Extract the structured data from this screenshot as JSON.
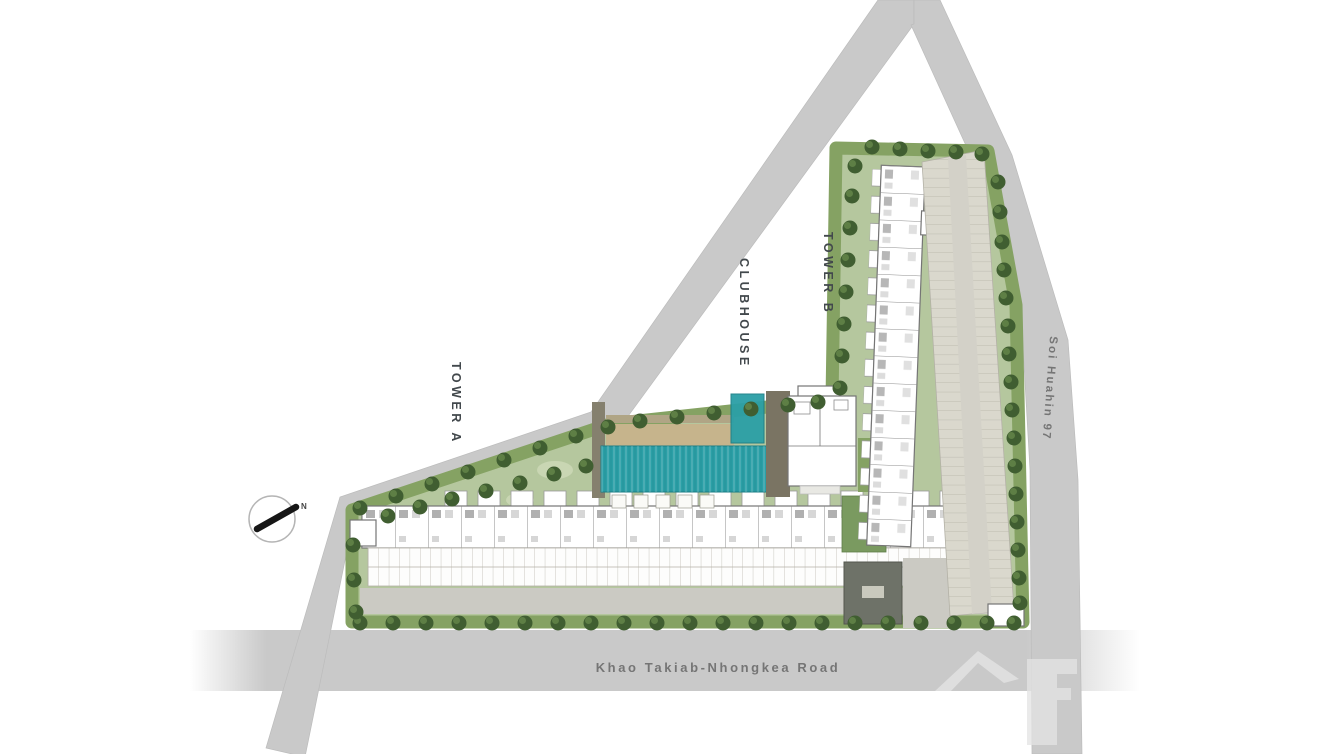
{
  "site_plan": {
    "buildings": [
      {
        "id": "tower-a",
        "label": "TOWER A"
      },
      {
        "id": "tower-b",
        "label": "TOWER B"
      },
      {
        "id": "clubhouse",
        "label": "CLUBHOUSE"
      }
    ],
    "roads": [
      {
        "id": "khao-takiab-road",
        "label": "Khao Takiab-Nhongkea Road",
        "orientation": "horizontal"
      },
      {
        "id": "soi-huahin-97",
        "label": "Soi Huahin 97",
        "orientation": "vertical"
      }
    ],
    "compass": {
      "north_label": "N"
    },
    "features": [
      "swimming-pool",
      "kids-pool",
      "sun-deck",
      "pool-cabanas",
      "parking-rows",
      "parking-structure",
      "entrance-lobby",
      "perimeter-hedge-trees"
    ],
    "icons": [
      "compass-icon",
      "logo-watermark"
    ],
    "colors": {
      "bg": "#ffffff",
      "road": "#c9c9c9",
      "road_edge": "#bcbcbc",
      "road_label": "#757575",
      "label": "#42484c",
      "lawn": "#b5c79e",
      "hedge": "#85a263",
      "tree_dark": "#405e31",
      "tree_mid": "#628348",
      "shrub": "#c9d6b3",
      "pool": "#2b9fa6",
      "pool_dark": "#1c7e86",
      "deck_tan": "#c6b48c",
      "pergola": "#b0a585",
      "wood": "#85806e",
      "wood_dark": "#7a7463",
      "bldg": "#ffffff",
      "bldg_stroke": "#757575",
      "unit_line": "#8d8d8d",
      "parking": "#dad8cd",
      "parking_line": "#b3b1a6",
      "aisle": "#d3d1c8",
      "drive": "#cbcac3",
      "lobby": "#6e7268",
      "lobby_stroke": "#54574e",
      "lobby_label": "#c9c9bd",
      "watermark": "#e4e4e4",
      "needle": "#161616",
      "compass_ring": "#b5b5b5"
    }
  }
}
